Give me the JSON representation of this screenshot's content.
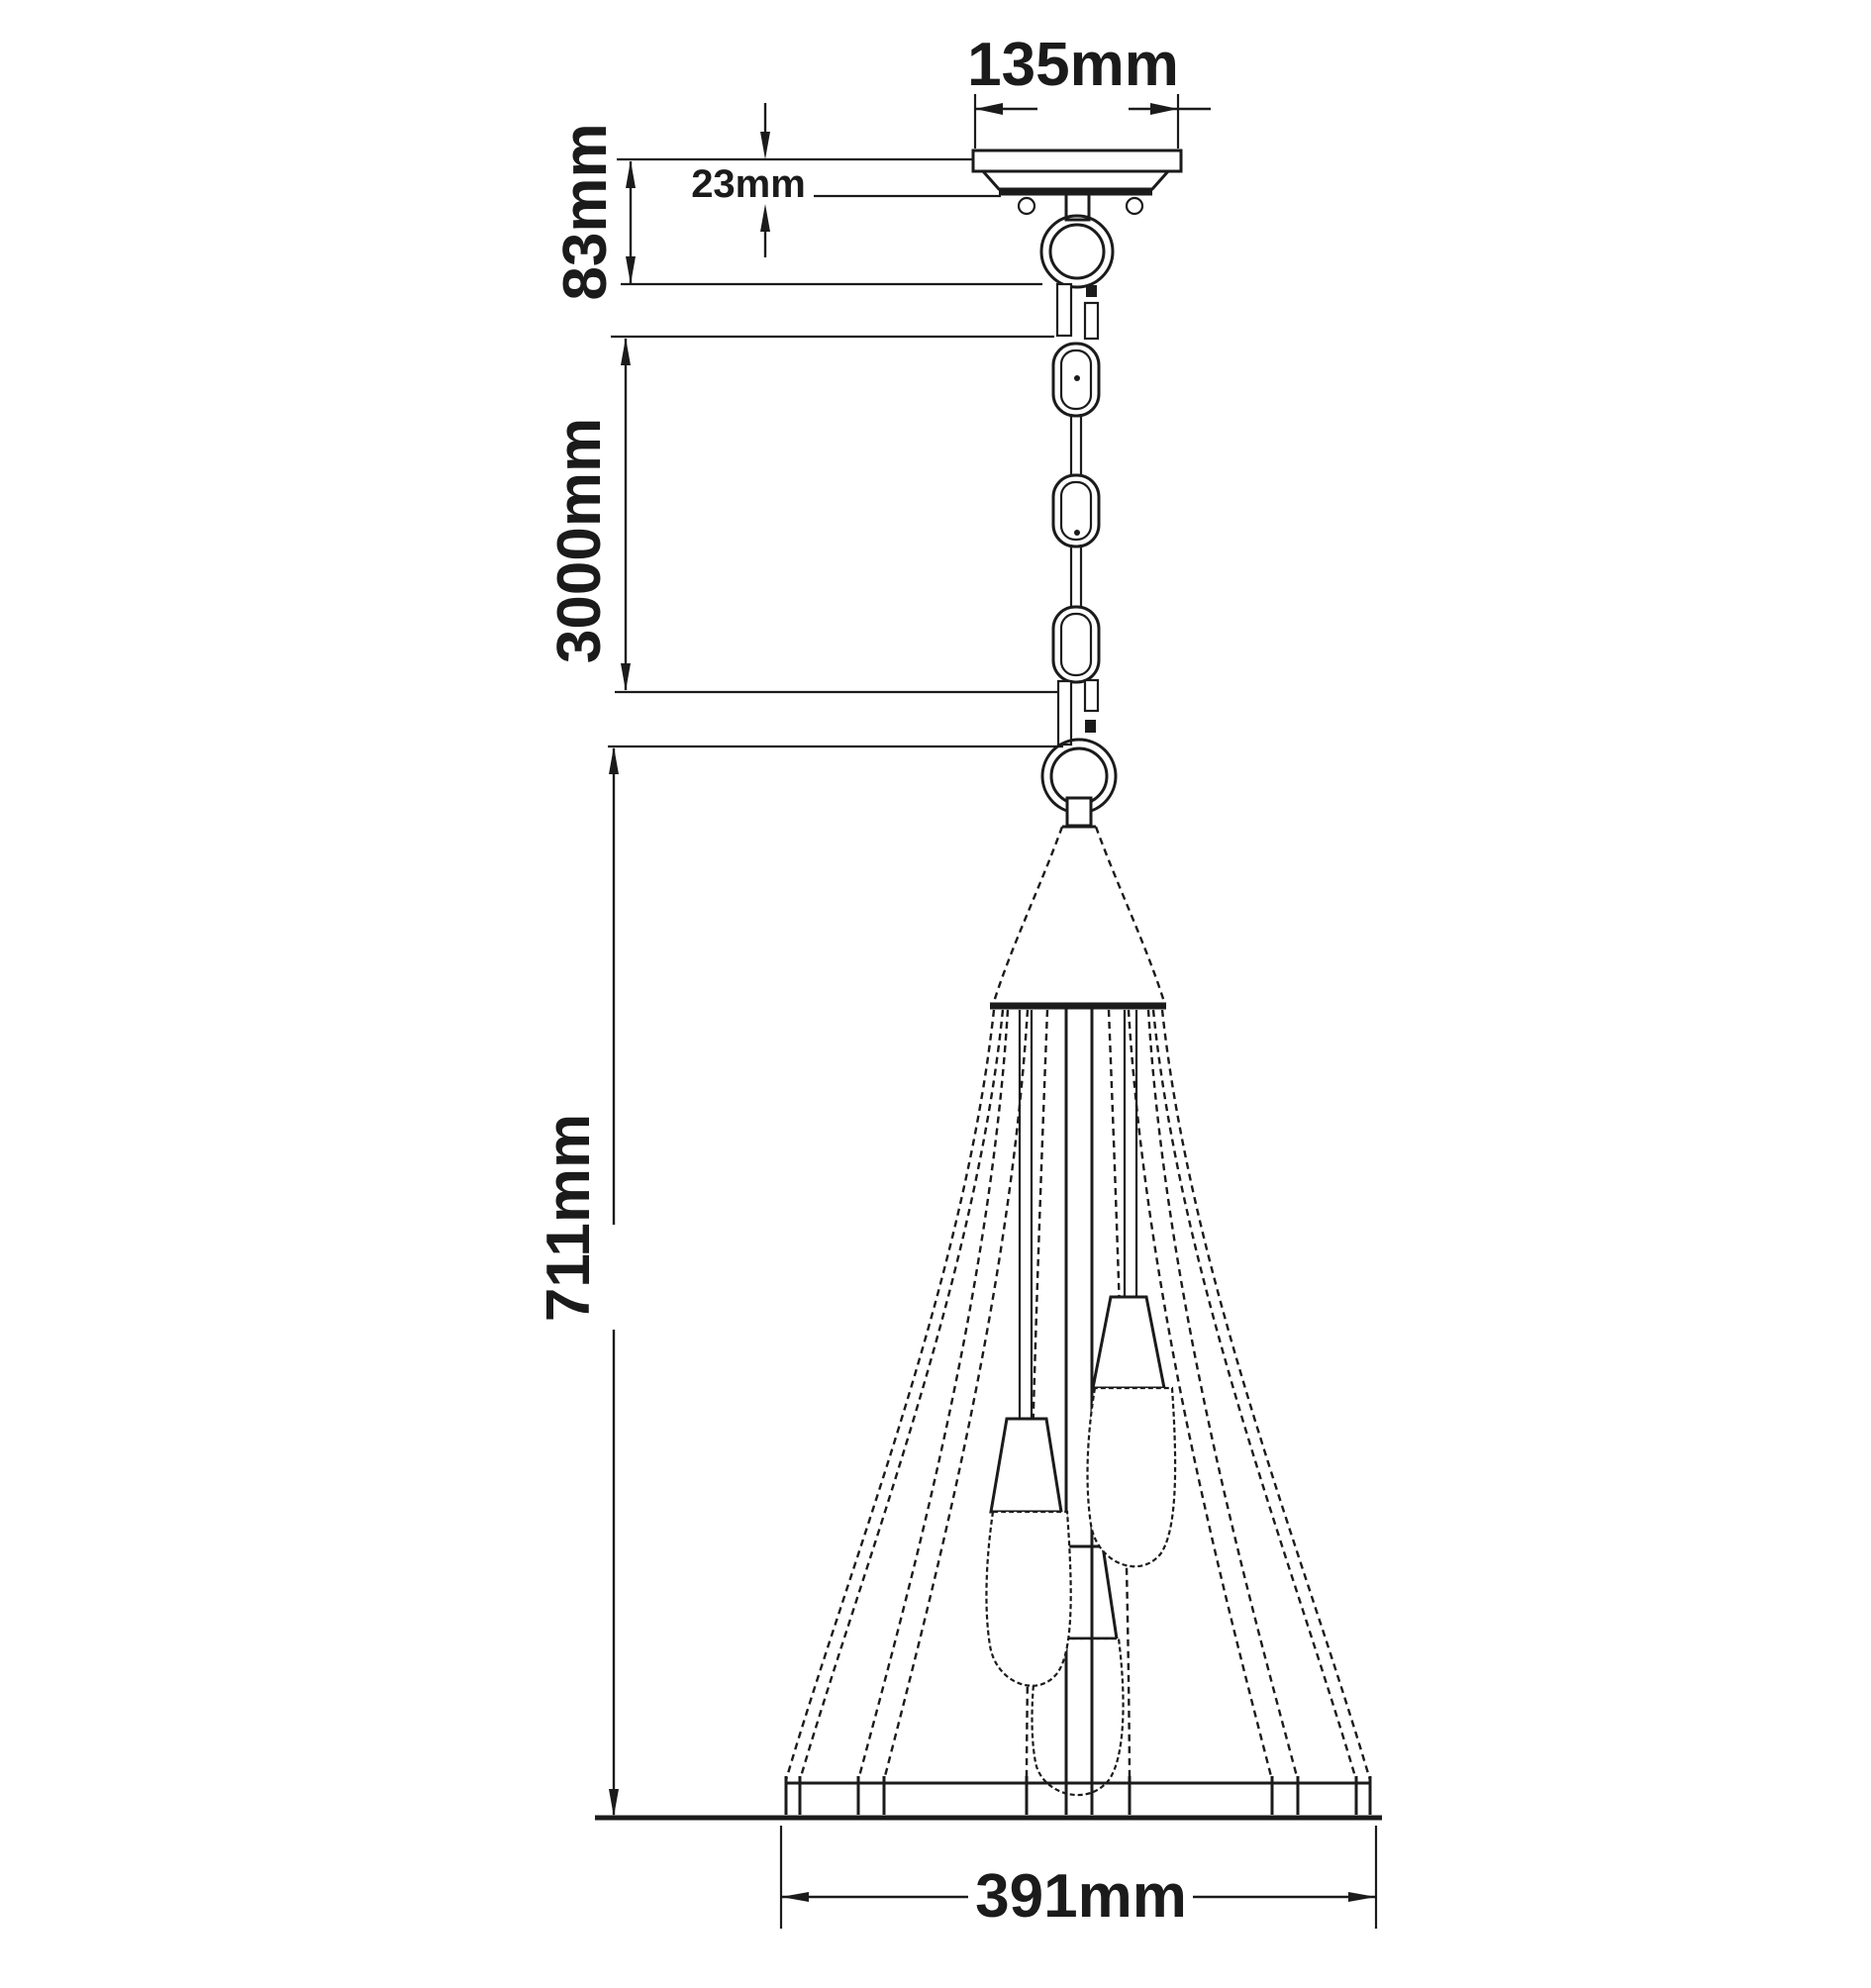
{
  "drawing": {
    "type": "pendant-light-dimension-diagram",
    "colors": {
      "ink": "#1b1b1b",
      "background": "#ffffff"
    },
    "dimensions": {
      "canopy_width": {
        "label": "135mm"
      },
      "canopy_drop": {
        "label": "23mm"
      },
      "mount_height": {
        "label": "83mm"
      },
      "chain_length": {
        "label": "3000mm"
      },
      "fixture_height": {
        "label": "711mm"
      },
      "shade_width": {
        "label": "391mm"
      }
    }
  }
}
